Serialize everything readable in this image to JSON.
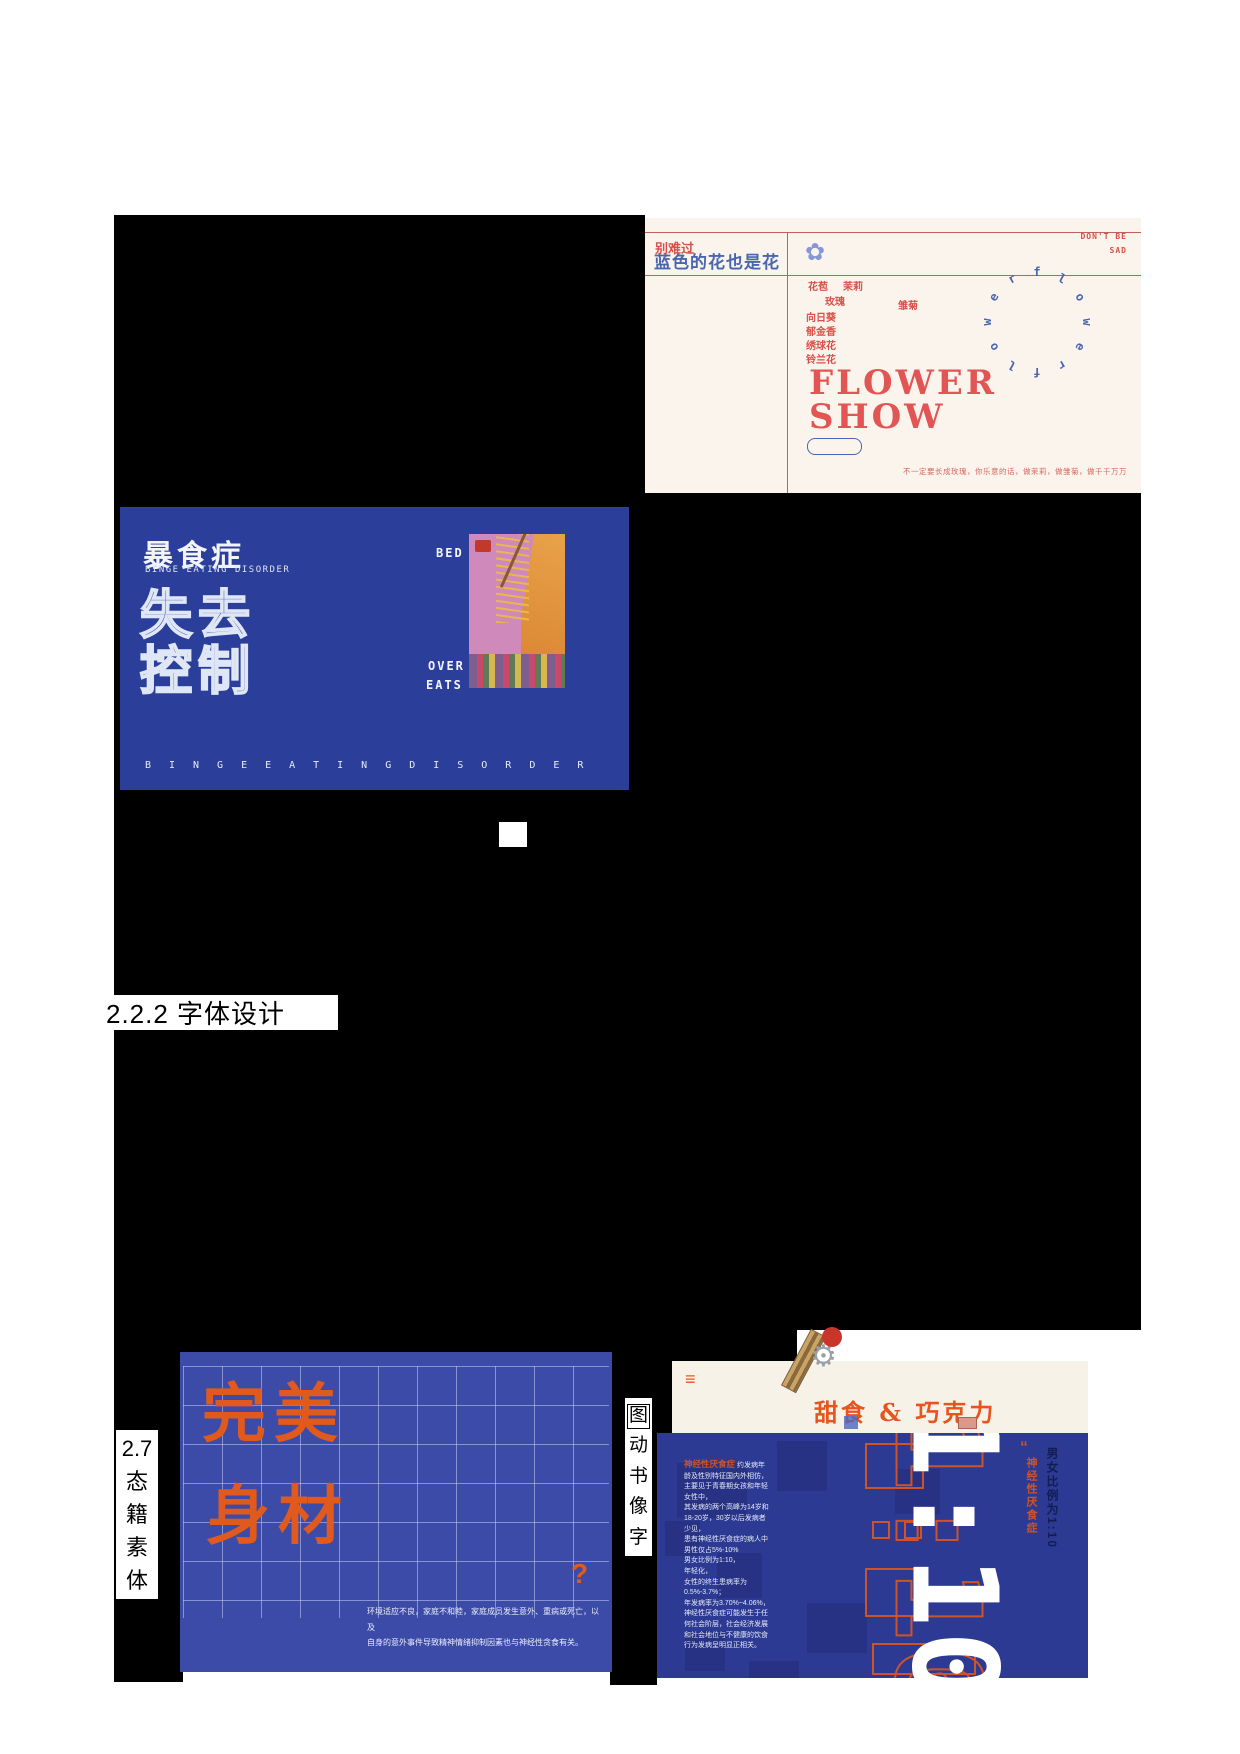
{
  "heading": {
    "text": "2.2.2 字体设计"
  },
  "left_caption": {
    "num": "2.7",
    "chars": [
      "态",
      "籍",
      "素",
      "体"
    ]
  },
  "center_caption": {
    "chars": [
      "图",
      "动",
      "书",
      "像",
      "字"
    ]
  },
  "flower_poster": {
    "colors": {
      "bg": "#faf4ec",
      "red": "#e25555",
      "line": "#c2605c",
      "blue": "#4a66b0"
    },
    "title_red": "别难过",
    "title_blue": "蓝色的花也是花",
    "corner_line1": "DON'T BE",
    "corner_line2": "SAD",
    "flower_icon": "✿",
    "names": [
      "花苞",
      "茉莉",
      "玫瑰",
      "雏菊",
      "向日葵",
      "郁金香",
      "绣球花",
      "铃兰花"
    ],
    "big_line1": "FLOWER",
    "big_line2": "SHOW",
    "ring_letters": [
      "f",
      "l",
      "o",
      "w",
      "e",
      "r",
      "f",
      "l",
      "o",
      "w",
      "e",
      "r"
    ],
    "footer": "不一定要长成玫瑰，你乐意的话，做茉莉，做雏菊，做千千万万"
  },
  "binge_poster": {
    "colors": {
      "bg": "#2a3e9a"
    },
    "title": "暴食症",
    "subtitle": "BINGE EATING DISORDER",
    "big_line1": "失去",
    "big_line2": "控制",
    "label_bed": "BED",
    "label_over": "OVER",
    "label_eats": "EATS",
    "footer": "BINGEEATINGDISORDER"
  },
  "figure_poster": {
    "colors": {
      "bg": "#3c4ba8",
      "orange": "#e05a1d"
    },
    "big_line1": "完美",
    "big_line2": "身材",
    "question": "?",
    "caption_line1": "环境适应不良，家庭不和睦，家庭成员发生意外、重病或死亡，以及",
    "caption_line2": "自身的意外事件导致精神情绪抑制因素也与神经性贪食有关。"
  },
  "sweets_poster": {
    "colors": {
      "bg": "#f6f2e8",
      "orange": "#e8541e"
    },
    "menu_icon": "≡",
    "title": "甜食 & 巧克力"
  },
  "ratio_poster": {
    "colors": {
      "bg": "#2c3a94",
      "orange": "#cf5327"
    },
    "para_title": "神经性厌食症",
    "para_first_line": "约发病年",
    "para_text": "龄及性别特征国内外相仿，\n主要见于青春期女孩和年轻\n女性中，\n其发病的两个高峰为14岁和\n18-20岁，30岁以后发病者\n少见，\n患有神经性厌食症的病人中\n男性仅占5%-10%\n男女比例为1:10，\n年轻化，\n女性的终生患病率为\n0.5%-3.7%；\n年发病率为3.70%~4.06%，\n神经性厌食症可能发生于任\n何社会阶层，社会经济发展\n和社会地位与不健康的饮食\n行为发病呈明显正相关。",
    "big_text": "1:10",
    "quote_mark": "“",
    "side_orange": "神经性厌食症",
    "side_dark": "男女比例为1:10"
  }
}
